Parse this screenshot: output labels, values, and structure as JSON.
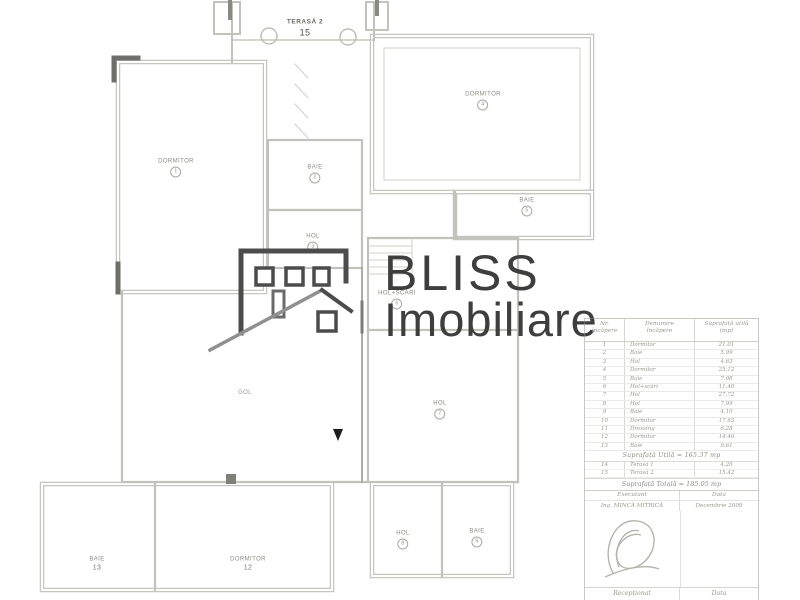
{
  "logo": {
    "brand_top": "BLISS",
    "brand_bottom": "Imobiliare"
  },
  "plan": {
    "rooms": {
      "terasa2": {
        "name": "TERASĂ 2",
        "num": "15"
      },
      "dormitor1": {
        "name": "DORMITOR",
        "num": "1"
      },
      "baie2": {
        "name": "BAIE",
        "num": "2"
      },
      "hol3": {
        "name": "HOL",
        "num": "3"
      },
      "dormitor4": {
        "name": "DORMITOR",
        "num": "4"
      },
      "baie5": {
        "name": "BAIE",
        "num": "5"
      },
      "hol_scari6": {
        "name": "HOL+SCĂRI",
        "num": "6"
      },
      "gol": {
        "name": "GOL"
      },
      "hol7": {
        "name": "HOL",
        "num": "7"
      },
      "hol8": {
        "name": "HOL",
        "num": "8"
      },
      "baie9": {
        "name": "BAIE",
        "num": "9"
      },
      "dormitor12": {
        "name": "DORMITOR",
        "num": "12"
      },
      "baie13": {
        "name": "BAIE",
        "num": "13"
      }
    }
  },
  "table": {
    "headers": {
      "nr": "Nr.\nîncăpere",
      "denumire": "Denumire\nîncăpere",
      "suprafata": "Suprafață utilă\n(mp)"
    },
    "rows": [
      {
        "nr": "1",
        "name": "Dormitor",
        "area": "21.01"
      },
      {
        "nr": "2",
        "name": "Baie",
        "area": "5.99"
      },
      {
        "nr": "3",
        "name": "Hol",
        "area": "4.63"
      },
      {
        "nr": "4",
        "name": "Dormitor",
        "area": "25.12"
      },
      {
        "nr": "5",
        "name": "Baie",
        "area": "7.08"
      },
      {
        "nr": "6",
        "name": "Hol+scări",
        "area": "11.40"
      },
      {
        "nr": "7",
        "name": "Hol",
        "area": "27.72"
      },
      {
        "nr": "8",
        "name": "Hol",
        "area": "7.99"
      },
      {
        "nr": "9",
        "name": "Baie",
        "area": "4.10"
      },
      {
        "nr": "10",
        "name": "Dormitor",
        "area": "17.63"
      },
      {
        "nr": "11",
        "name": "Dressing",
        "area": "6.28"
      },
      {
        "nr": "12",
        "name": "Dormitor",
        "area": "14.46"
      },
      {
        "nr": "13",
        "name": "Baie",
        "area": "9.61"
      }
    ],
    "subtotal": "Suprafață Utilă = 165.37 mp",
    "terasa_rows": [
      {
        "nr": "14",
        "name": "Terasă 1",
        "area": "4.26"
      },
      {
        "nr": "15",
        "name": "Terasă 2",
        "area": "15.42"
      }
    ],
    "total": "Suprafață Totală = 185.05 mp",
    "executant_label": "Executant",
    "data_label": "Data",
    "executant_name": "Ing. MINCĂ MITRICĂ",
    "executant_date": "Decembrie 2009",
    "receptionat_label": "Recepționat",
    "receptionat_data_label": "Data"
  }
}
